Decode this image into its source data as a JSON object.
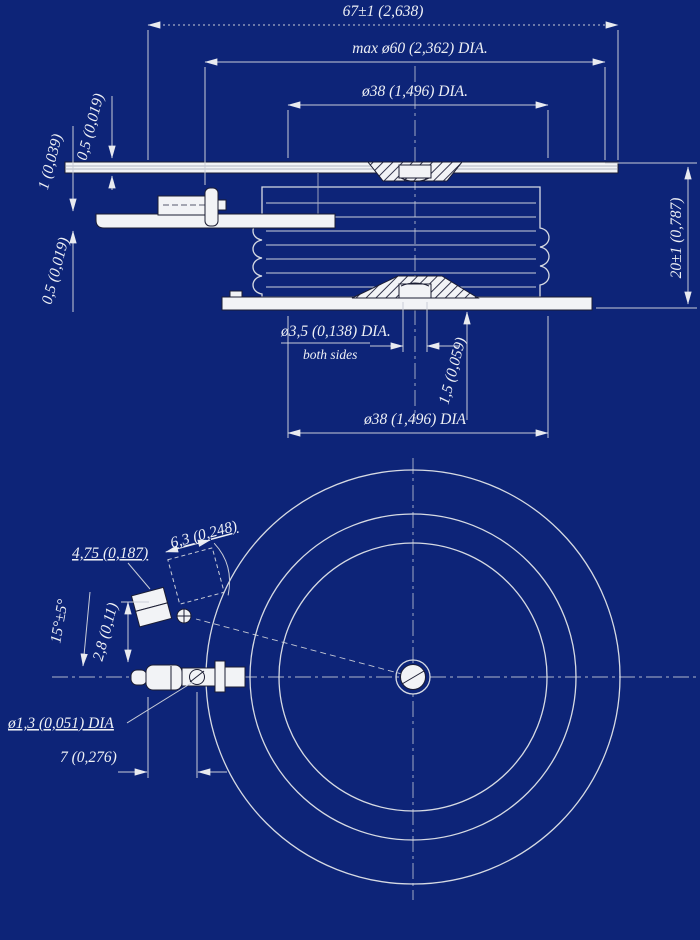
{
  "meta": {
    "background": "#0d2478",
    "line_color": "#d6dae3",
    "text_color": "#eef0f5"
  },
  "side_view": {
    "dim_overall_width": "67±1 (2,638)",
    "dim_max_diameter": "max ø60 (2,362) DIA.",
    "dim_pole_face_top": "ø38 (1,496) DIA.",
    "dim_height": "20±1 (0,787)",
    "dim_top_lead_thickness": "0,5 (0,019)",
    "dim_gate_lead_thickness": "1 (0,039)",
    "dim_aux_lead_thickness": "0,5 (0,019)",
    "dim_center_recess_diameter": "ø3,5 (0,138) DIA.",
    "note_recess_both_sides": "both sides",
    "dim_recess_depth": "1,5 (0,059)",
    "dim_pole_face_bottom": "ø38 (1,496) DIA"
  },
  "bottom_view": {
    "dim_terminal_pad": "6,3 (0,248)",
    "dim_terminal_width": "4,75 (0,187)",
    "dim_terminal_angle": "15°±5°",
    "dim_terminal_offset": "2,8 (0,11)",
    "dim_terminal_hole_diameter": "ø1,3 (0,051) DIA",
    "dim_terminal_hole_position": "7 (0,276)"
  }
}
